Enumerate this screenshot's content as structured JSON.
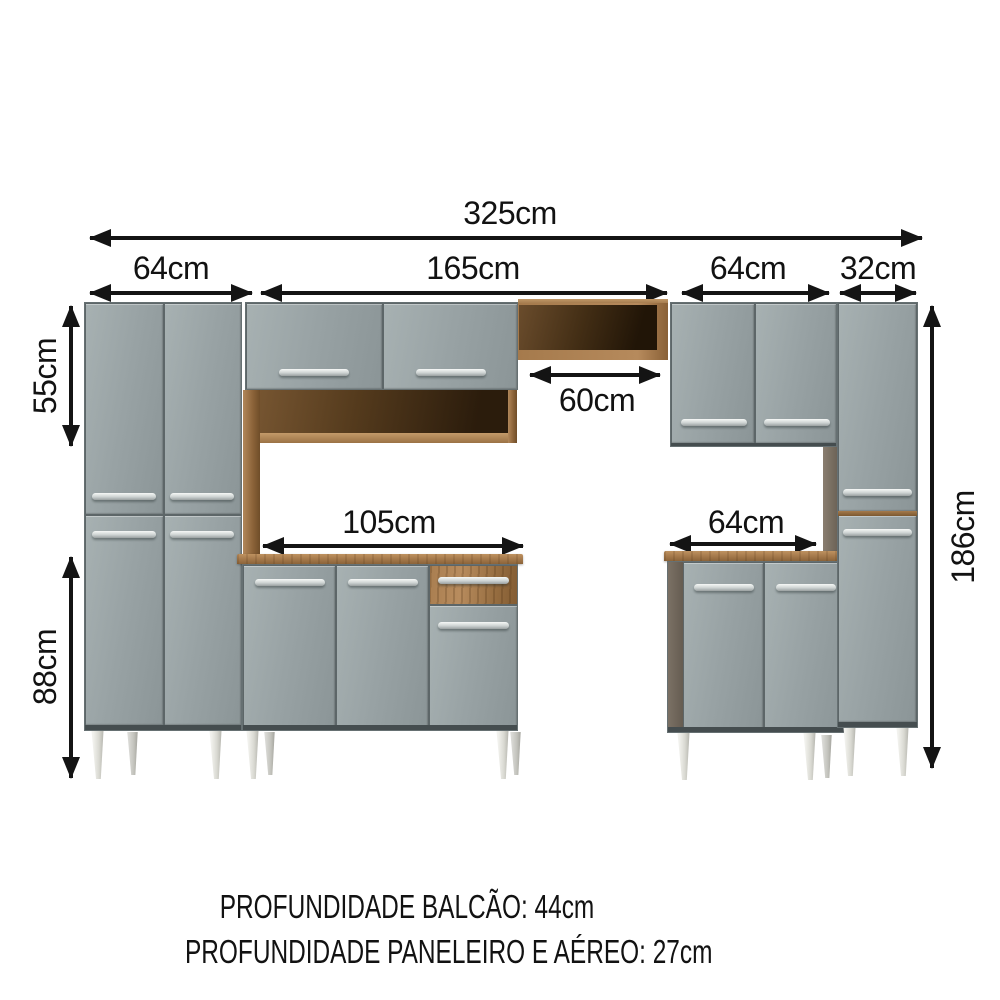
{
  "diagram": {
    "total_width": "325cm",
    "paneleiro_width": "64cm",
    "hutch_width": "165cm",
    "aereo_width": "64cm",
    "slim_cabinet_width": "32cm",
    "upper_section_height": "55cm",
    "lower_section_height": "88cm",
    "niche_width": "60cm",
    "center_base_width": "105cm",
    "right_base_width": "64cm",
    "total_height": "186cm"
  },
  "footer": {
    "line1": "PROFUNDIDADE BALCÃO: 44cm",
    "line2": "PROFUNDIDADE PANELEIRO E AÉREO: 27cm"
  },
  "colors": {
    "door_gray": "#97a1a3",
    "wood": "#a87c4e",
    "wood_interior_dark": "#2a1c0e",
    "handle_silver": "#eef1f0",
    "leg_silver": "#e6e6e0",
    "dimension_line": "#141414",
    "background": "#ffffff"
  }
}
